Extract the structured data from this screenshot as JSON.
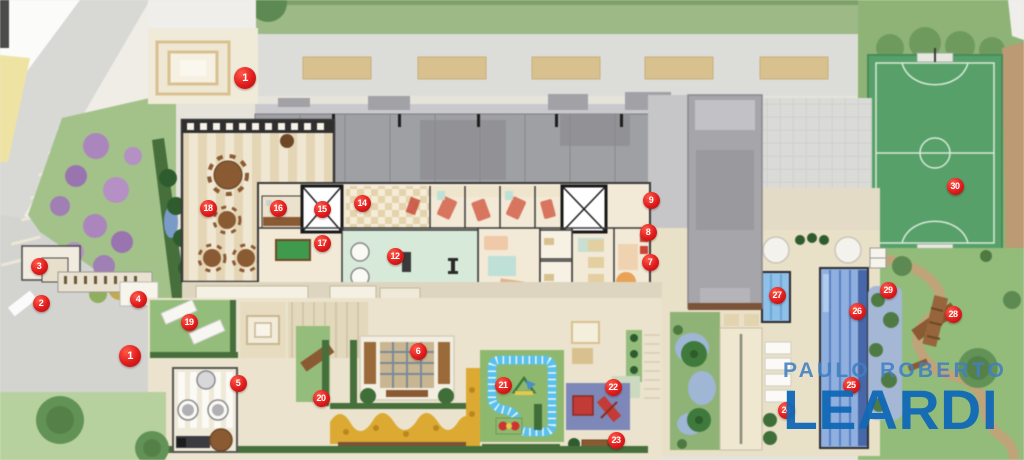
{
  "plan": {
    "watermark": {
      "line1": "PAULO ROBERTO",
      "line2": "LEARDI"
    },
    "colors": {
      "marker_red": "#e01c1c",
      "logo_blue": "#1269b6",
      "logo_light_blue": "#407ec1",
      "field_green": "#57a069",
      "pool_blue": "#8fb0de",
      "lawn_green": "#9cb986",
      "deck_beige": "#e9e0c8"
    },
    "markers": [
      {
        "n": "1",
        "x": 245,
        "y": 78,
        "large": true
      },
      {
        "n": "2",
        "x": 41,
        "y": 303
      },
      {
        "n": "3",
        "x": 39,
        "y": 266
      },
      {
        "n": "4",
        "x": 138,
        "y": 299
      },
      {
        "n": "1",
        "x": 130,
        "y": 356,
        "large": true
      },
      {
        "n": "5",
        "x": 238,
        "y": 383
      },
      {
        "n": "6",
        "x": 418,
        "y": 351
      },
      {
        "n": "7",
        "x": 650,
        "y": 262
      },
      {
        "n": "8",
        "x": 648,
        "y": 232
      },
      {
        "n": "9",
        "x": 651,
        "y": 200
      },
      {
        "n": "12",
        "x": 395,
        "y": 256
      },
      {
        "n": "14",
        "x": 362,
        "y": 203
      },
      {
        "n": "15",
        "x": 322,
        "y": 209
      },
      {
        "n": "16",
        "x": 278,
        "y": 208
      },
      {
        "n": "17",
        "x": 322,
        "y": 243
      },
      {
        "n": "18",
        "x": 208,
        "y": 208
      },
      {
        "n": "19",
        "x": 189,
        "y": 322
      },
      {
        "n": "20",
        "x": 321,
        "y": 398
      },
      {
        "n": "21",
        "x": 503,
        "y": 385
      },
      {
        "n": "22",
        "x": 613,
        "y": 387
      },
      {
        "n": "23",
        "x": 616,
        "y": 440
      },
      {
        "n": "24",
        "x": 786,
        "y": 410
      },
      {
        "n": "25",
        "x": 851,
        "y": 385
      },
      {
        "n": "26",
        "x": 857,
        "y": 311
      },
      {
        "n": "27",
        "x": 777,
        "y": 295
      },
      {
        "n": "28",
        "x": 953,
        "y": 314
      },
      {
        "n": "29",
        "x": 888,
        "y": 290
      },
      {
        "n": "30",
        "x": 955,
        "y": 186
      }
    ]
  }
}
